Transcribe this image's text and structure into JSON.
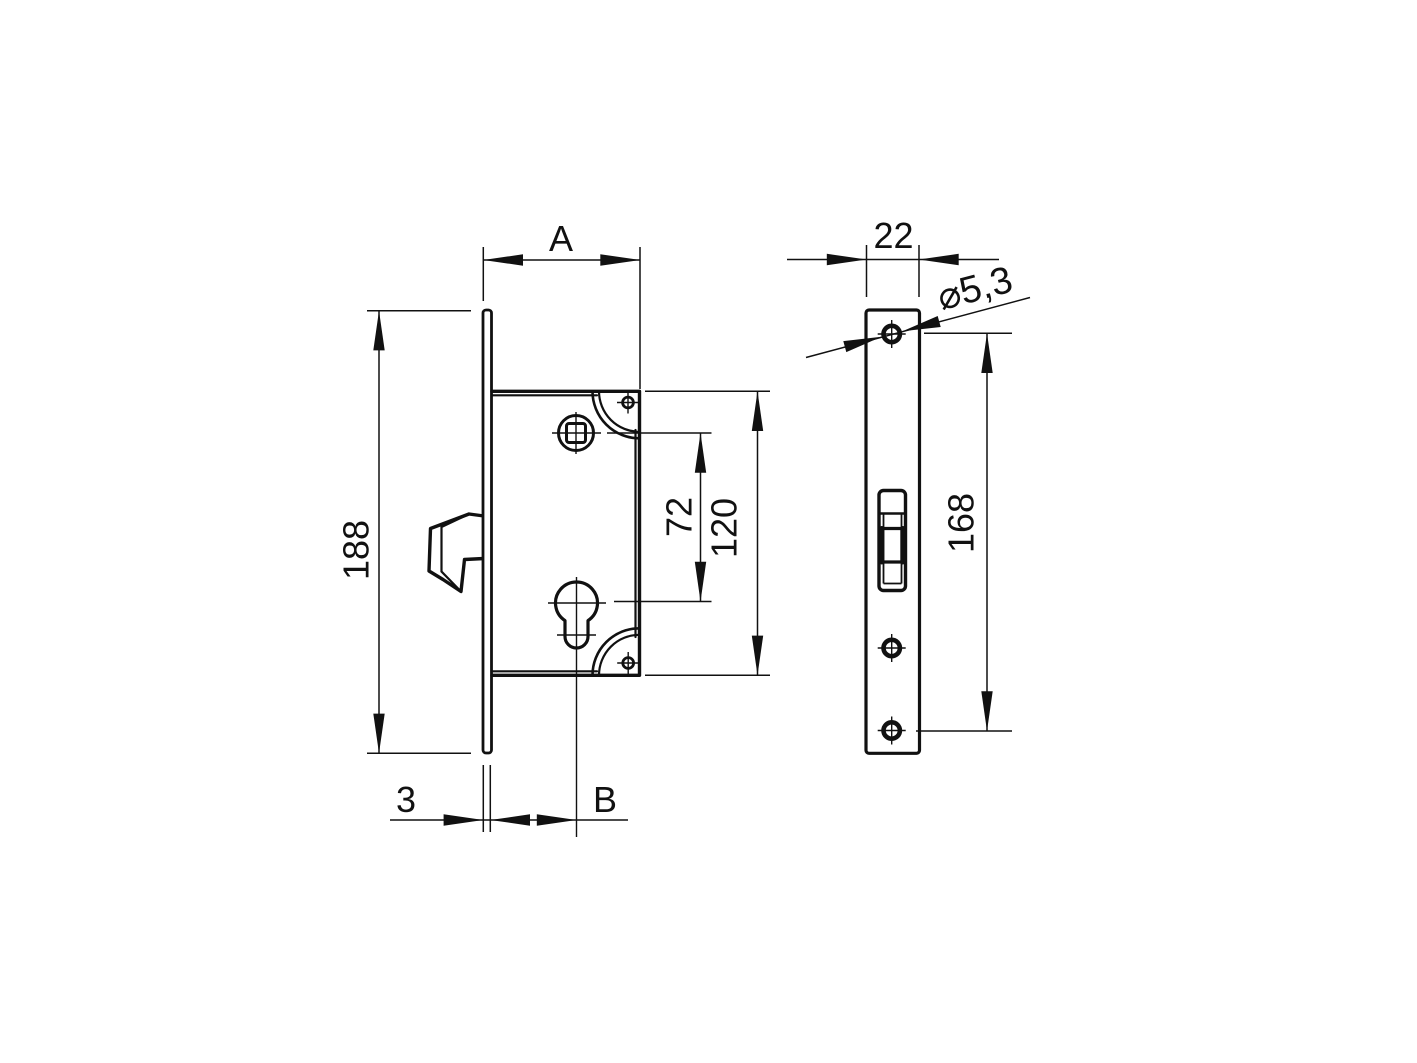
{
  "title": "Mortise hook lock dimension drawing",
  "colors": {
    "ink": "#111111",
    "background": "#ffffff"
  },
  "front_view": {
    "dim_width_label": "A",
    "dim_height_label": "188",
    "dim_follower_to_cylinder_label": "72",
    "dim_case_height_label": "120",
    "dim_plate_thickness_label": "3",
    "dim_backset_label": "B"
  },
  "side_view": {
    "dim_plate_width_label": "22",
    "dim_hole_diameter_label": "⌀5,3",
    "dim_screw_spacing_label": "168"
  }
}
